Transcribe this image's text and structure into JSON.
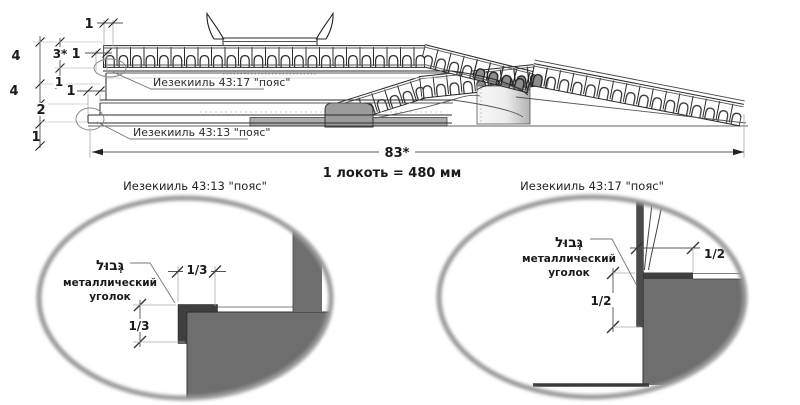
{
  "main": {
    "label_belt_4317": "Иезекииль 43:17 \"пояс\"",
    "label_belt_4313": "Иезекииль 43:13 \"пояс\"",
    "dim_total": "83*",
    "dims_top": [
      "1",
      "1",
      "1"
    ],
    "dims_left_outer": [
      "4",
      "4",
      "2",
      "1"
    ],
    "dims_left_inner": [
      "3*",
      "1"
    ]
  },
  "scale_note": "1 локоть = 480 мм",
  "detail_left": {
    "title": "Иезекииль 43:13 \"пояс\"",
    "hebrew": "גְּבוּל",
    "label_line1": "металлический",
    "label_line2": "уголок",
    "dim_h": "1/3",
    "dim_v": "1/3"
  },
  "detail_right": {
    "title": "Иезекииль 43:17 \"пояс\"",
    "hebrew": "גְּבוּל",
    "label_line1": "металлический",
    "label_line2": "уголок",
    "dim_h": "1/2",
    "dim_v": "1/2"
  },
  "colors": {
    "line": "#2b2b2b",
    "detail_gray": "#6e6e6e",
    "bracket_dark": "#3f3f3f",
    "pedestal_gray": "#9b9b9b",
    "bar_gray": "#ababab"
  }
}
